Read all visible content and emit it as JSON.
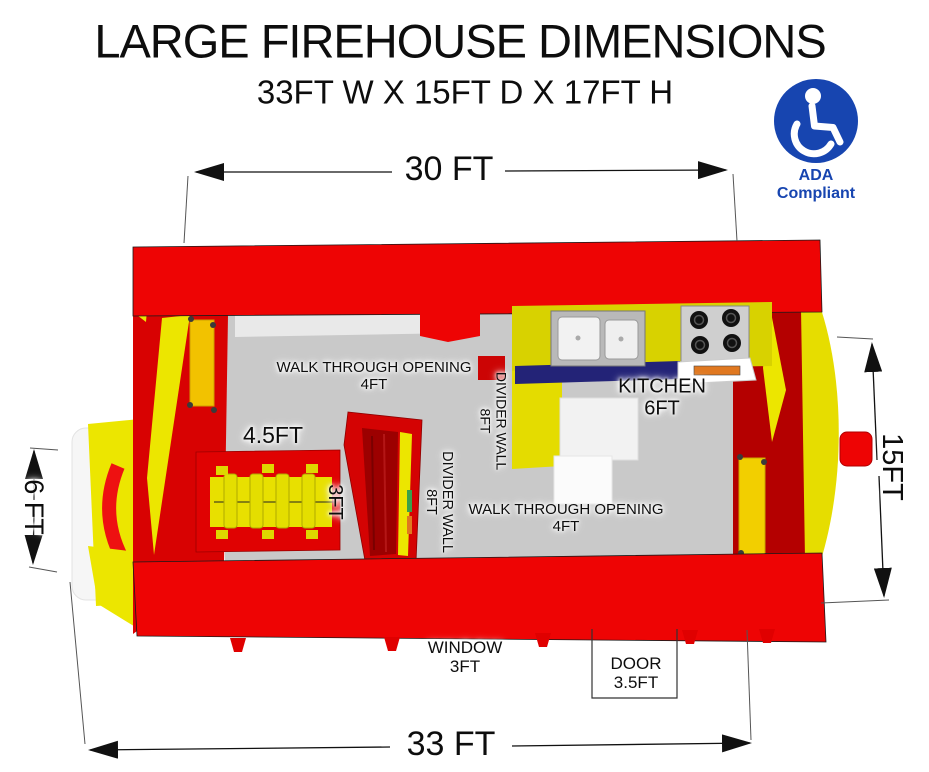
{
  "title": "LARGE FIREHOUSE DIMENSIONS",
  "subtitle": "33FT W X 15FT D X 17FT H",
  "badge": {
    "label": "ADA Compliant",
    "icon": "wheelchair"
  },
  "dimensions": {
    "top_width": "30 FT",
    "bottom_width": "33 FT",
    "left_height": "6 FT",
    "right_depth": "15FT"
  },
  "plan": {
    "walk_through_top": {
      "name": "WALK THROUGH OPENING",
      "size": "4FT"
    },
    "divider_wall_upper": {
      "name": "DIVIDER WALL",
      "size": "8FT"
    },
    "kitchen": {
      "name": "KITCHEN",
      "size": "6FT"
    },
    "bench": {
      "width": "4.5FT",
      "depth": "3FT"
    },
    "divider_wall_lower": {
      "name": "DIVIDER WALL",
      "size": "8FT"
    },
    "walk_through_bottom": {
      "name": "WALK THROUGH OPENING",
      "size": "4FT"
    },
    "window": {
      "name": "WINDOW",
      "size": "3FT"
    },
    "door": {
      "name": "DOOR",
      "size": "3.5FT"
    }
  },
  "colors": {
    "wall_red": "#ee0404",
    "wall_red_dark": "#b40000",
    "accent_yellow": "#ece600",
    "floor_gray": "#c9c9c9",
    "counter_navy": "#232377",
    "ada_blue": "#1745b0"
  }
}
